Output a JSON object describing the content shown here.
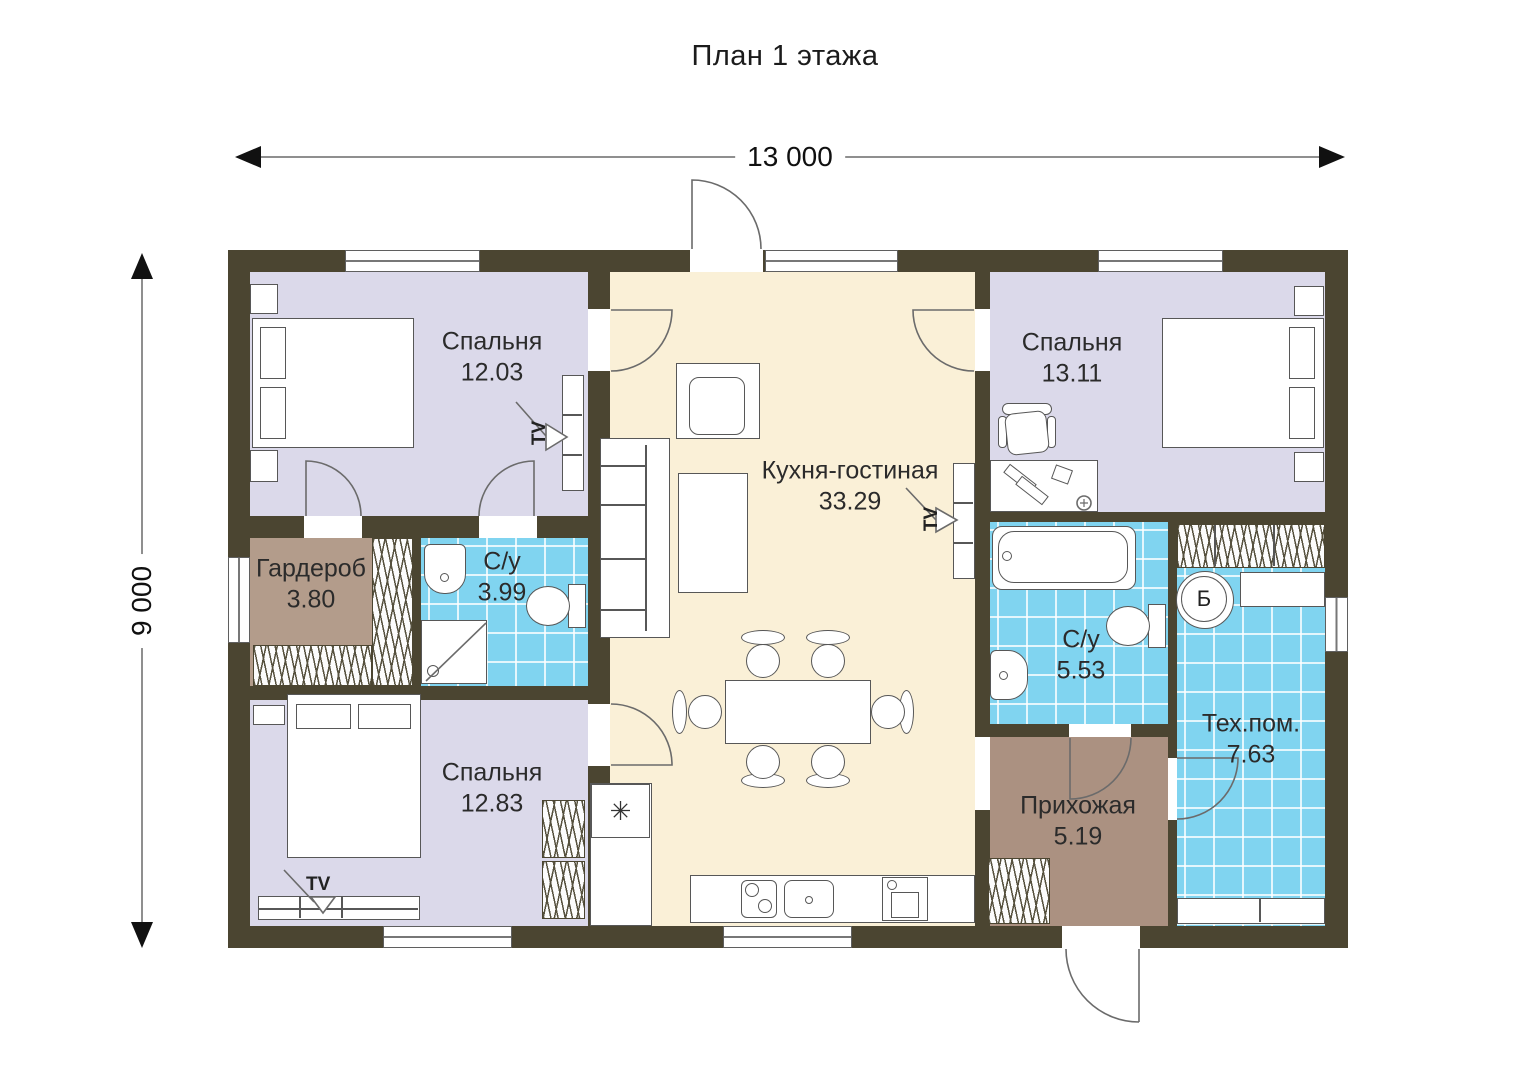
{
  "title": "План 1 этажа",
  "dimensions": {
    "width": "13 000",
    "height": "9 000"
  },
  "rooms": {
    "bedroom_top_left": {
      "name": "Спальня",
      "area": "12.03"
    },
    "bedroom_top_right": {
      "name": "Спальня",
      "area": "13.11"
    },
    "bedroom_bottom_left": {
      "name": "Спальня",
      "area": "12.83"
    },
    "kitchen_living": {
      "name": "Кухня-гостиная",
      "area": "33.29"
    },
    "wardrobe": {
      "name": "Гардероб",
      "area": "3.80"
    },
    "bathroom_small": {
      "name": "С/у",
      "area": "3.99"
    },
    "bathroom_large": {
      "name": "С/у",
      "area": "5.53"
    },
    "hallway": {
      "name": "Прихожая",
      "area": "5.19"
    },
    "tech_room": {
      "name": "Тех.пом.",
      "area": "7.63"
    }
  },
  "symbols": {
    "tv": "TV",
    "boiler": "Б",
    "fridge": "✳"
  },
  "colors": {
    "wall": "#4b4531",
    "bedroom_floor": "#dbd9ea",
    "kitchen_floor": "#faf0d7",
    "wet_room_floor": "#80d4f0",
    "wardrobe_floor": "#b39c8b",
    "hallway_floor": "#ab9181"
  }
}
